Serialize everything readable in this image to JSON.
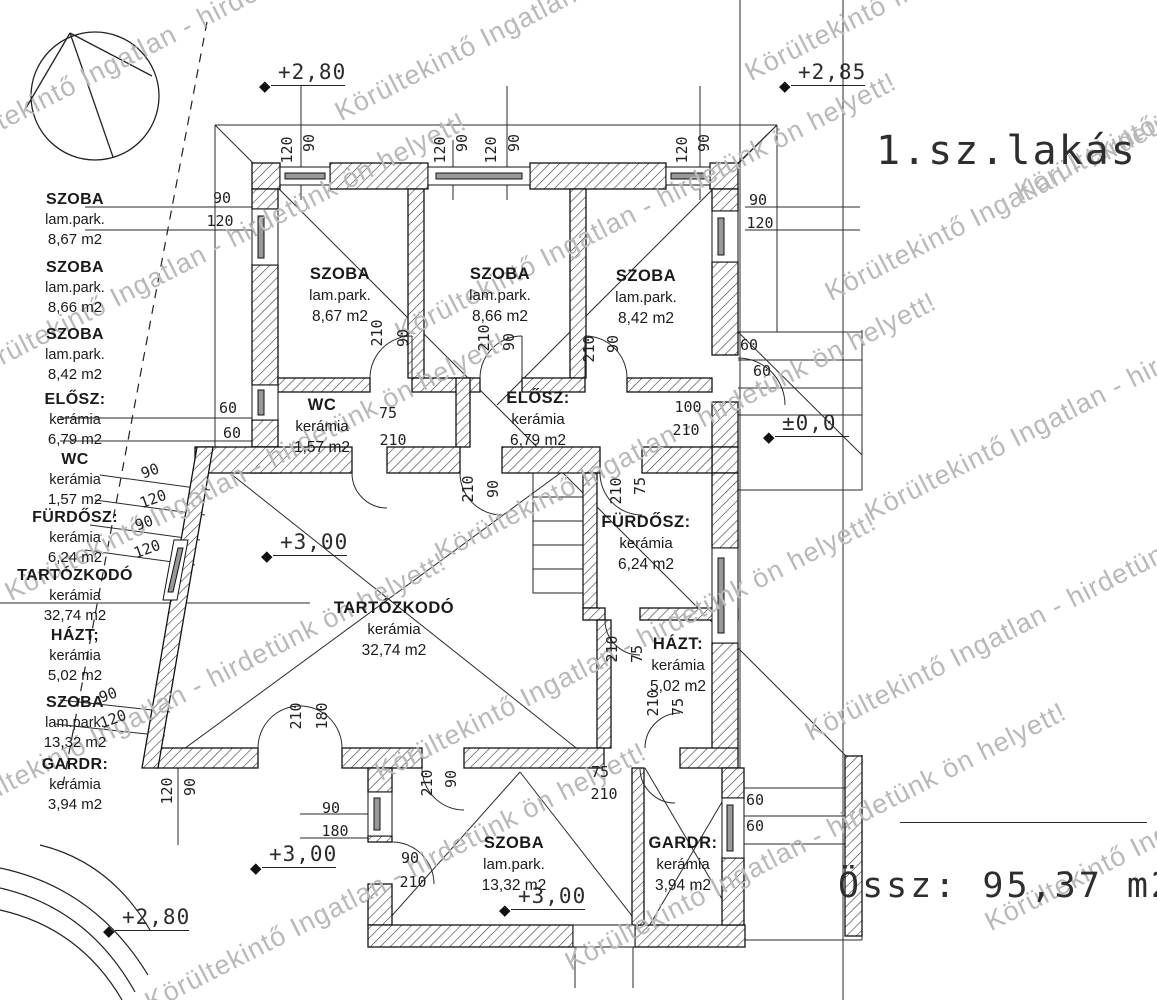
{
  "watermark": {
    "text": "Körültekintő Ingatlan - hirdetünk ön helyett!",
    "color": "#b9b9b9",
    "positions": [
      {
        "x": -70,
        "y": 140
      },
      {
        "x": 330,
        "y": 100
      },
      {
        "x": 740,
        "y": 60
      },
      {
        "x": 1010,
        "y": 180
      },
      {
        "x": -40,
        "y": 360
      },
      {
        "x": 390,
        "y": 320
      },
      {
        "x": 820,
        "y": 280
      },
      {
        "x": 0,
        "y": 580
      },
      {
        "x": 430,
        "y": 540
      },
      {
        "x": 860,
        "y": 500
      },
      {
        "x": -60,
        "y": 800
      },
      {
        "x": 370,
        "y": 760
      },
      {
        "x": 800,
        "y": 720
      },
      {
        "x": 140,
        "y": 990
      },
      {
        "x": 560,
        "y": 950
      },
      {
        "x": 980,
        "y": 910
      }
    ]
  },
  "legend": {
    "title": "1.sz.lakás",
    "total": "Össz: 95,37 m2",
    "entries": [
      {
        "name": "SZOBA",
        "material": "lam.park.",
        "area": "8,67 m2",
        "y": 190
      },
      {
        "name": "SZOBA",
        "material": "lam.park.",
        "area": "8,66 m2",
        "y": 258
      },
      {
        "name": "SZOBA",
        "material": "lam.park.",
        "area": "8,42 m2",
        "y": 325
      },
      {
        "name": "ELŐSZ:",
        "material": "kerámia",
        "area": "6,79 m2",
        "y": 390
      },
      {
        "name": "WC",
        "material": "kerámia",
        "area": "1,57 m2",
        "y": 450
      },
      {
        "name": "FÜRDŐSZ:",
        "material": "kerámia",
        "area": "6,24 m2",
        "y": 508
      },
      {
        "name": "TARTÓZKODÓ",
        "material": "kerámia",
        "area": "32,74 m2",
        "y": 566
      },
      {
        "name": "HÁZT;",
        "material": "kerámia",
        "area": "5,02 m2",
        "y": 626
      },
      {
        "name": "SZOBA",
        "material": "lam.park.",
        "area": "13,32 m2",
        "y": 693
      },
      {
        "name": "GARDR:",
        "material": "kerámia",
        "area": "3,94 m2",
        "y": 755
      }
    ]
  },
  "rooms": [
    {
      "name": "SZOBA",
      "material": "lam.park.",
      "area": "8,67 m2",
      "x": 340,
      "y": 264
    },
    {
      "name": "SZOBA",
      "material": "lam.park.",
      "area": "8,66 m2",
      "x": 500,
      "y": 264
    },
    {
      "name": "SZOBA",
      "material": "lam.park.",
      "area": "8,42 m2",
      "x": 646,
      "y": 266
    },
    {
      "name": "WC",
      "material": "kerámia",
      "area": "1,57 m2",
      "x": 322,
      "y": 395
    },
    {
      "name": "ELŐSZ:",
      "material": "kerámia",
      "area": "6,79 m2",
      "x": 538,
      "y": 388
    },
    {
      "name": "FÜRDŐSZ:",
      "material": "kerámia",
      "area": "6,24 m2",
      "x": 646,
      "y": 512
    },
    {
      "name": "TARTÓZKODÓ",
      "material": "kerámia",
      "area": "32,74 m2",
      "x": 394,
      "y": 598
    },
    {
      "name": "HÁZT:",
      "material": "kerámia",
      "area": "5,02 m2",
      "x": 678,
      "y": 634
    },
    {
      "name": "SZOBA",
      "material": "lam.park.",
      "area": "13,32 m2",
      "x": 514,
      "y": 833
    },
    {
      "name": "GARDR:",
      "material": "kerámia",
      "area": "3,94 m2",
      "x": 683,
      "y": 833
    }
  ],
  "elevation_markers": [
    {
      "label": "+2,80",
      "x": 266,
      "y": 86
    },
    {
      "label": "+2,85",
      "x": 786,
      "y": 86
    },
    {
      "label": "±0,0",
      "x": 770,
      "y": 437
    },
    {
      "label": "+3,00",
      "x": 268,
      "y": 556
    },
    {
      "label": "+3,00",
      "x": 257,
      "y": 868
    },
    {
      "label": "+3,00",
      "x": 506,
      "y": 910
    },
    {
      "label": "+2,80",
      "x": 110,
      "y": 931
    }
  ],
  "dim_labels": [
    {
      "t": "120",
      "x": 287,
      "y": 150,
      "r": -90
    },
    {
      "t": "90",
      "x": 309,
      "y": 143,
      "r": -90
    },
    {
      "t": "120",
      "x": 440,
      "y": 150,
      "r": -90
    },
    {
      "t": "90",
      "x": 462,
      "y": 143,
      "r": -90
    },
    {
      "t": "120",
      "x": 491,
      "y": 150,
      "r": -90
    },
    {
      "t": "90",
      "x": 514,
      "y": 143,
      "r": -90
    },
    {
      "t": "120",
      "x": 682,
      "y": 150,
      "r": -90
    },
    {
      "t": "90",
      "x": 704,
      "y": 143,
      "r": -90
    },
    {
      "t": "90",
      "x": 222,
      "y": 198,
      "r": 0
    },
    {
      "t": "120",
      "x": 220,
      "y": 221,
      "r": 0
    },
    {
      "t": "90",
      "x": 758,
      "y": 200,
      "r": 0
    },
    {
      "t": "120",
      "x": 760,
      "y": 223,
      "r": 0
    },
    {
      "t": "60",
      "x": 749,
      "y": 345,
      "r": 0
    },
    {
      "t": "60",
      "x": 762,
      "y": 371,
      "r": 0
    },
    {
      "t": "60",
      "x": 228,
      "y": 408,
      "r": 0
    },
    {
      "t": "60",
      "x": 232,
      "y": 433,
      "r": 0
    },
    {
      "t": "90",
      "x": 150,
      "y": 471,
      "r": -20
    },
    {
      "t": "120",
      "x": 153,
      "y": 499,
      "r": -20
    },
    {
      "t": "90",
      "x": 144,
      "y": 523,
      "r": -20
    },
    {
      "t": "120",
      "x": 147,
      "y": 549,
      "r": -20
    },
    {
      "t": "90",
      "x": 108,
      "y": 695,
      "r": -20
    },
    {
      "t": "120",
      "x": 113,
      "y": 719,
      "r": -20
    },
    {
      "t": "210",
      "x": 296,
      "y": 716,
      "r": -90
    },
    {
      "t": "180",
      "x": 322,
      "y": 716,
      "r": -90
    },
    {
      "t": "120",
      "x": 167,
      "y": 791,
      "r": -90
    },
    {
      "t": "90",
      "x": 190,
      "y": 787,
      "r": -90
    },
    {
      "t": "90",
      "x": 331,
      "y": 808,
      "r": 0
    },
    {
      "t": "180",
      "x": 335,
      "y": 831,
      "r": 0
    },
    {
      "t": "210",
      "x": 377,
      "y": 333,
      "r": -90
    },
    {
      "t": "90",
      "x": 403,
      "y": 338,
      "r": -90
    },
    {
      "t": "210",
      "x": 484,
      "y": 338,
      "r": -90
    },
    {
      "t": "90",
      "x": 509,
      "y": 342,
      "r": -90
    },
    {
      "t": "210",
      "x": 589,
      "y": 349,
      "r": -90
    },
    {
      "t": "90",
      "x": 613,
      "y": 344,
      "r": -90
    },
    {
      "t": "75",
      "x": 388,
      "y": 413,
      "r": 0
    },
    {
      "t": "210",
      "x": 393,
      "y": 440,
      "r": 0
    },
    {
      "t": "210",
      "x": 468,
      "y": 489,
      "r": -90
    },
    {
      "t": "90",
      "x": 493,
      "y": 489,
      "r": -90
    },
    {
      "t": "210",
      "x": 616,
      "y": 491,
      "r": -90
    },
    {
      "t": "75",
      "x": 640,
      "y": 486,
      "r": -90
    },
    {
      "t": "100",
      "x": 688,
      "y": 407,
      "r": 0
    },
    {
      "t": "210",
      "x": 686,
      "y": 430,
      "r": 0
    },
    {
      "t": "210",
      "x": 612,
      "y": 649,
      "r": -90
    },
    {
      "t": "75",
      "x": 637,
      "y": 654,
      "r": -90
    },
    {
      "t": "210",
      "x": 653,
      "y": 703,
      "r": -90
    },
    {
      "t": "75",
      "x": 678,
      "y": 707,
      "r": -90
    },
    {
      "t": "210",
      "x": 427,
      "y": 783,
      "r": -90
    },
    {
      "t": "90",
      "x": 451,
      "y": 779,
      "r": -90
    },
    {
      "t": "75",
      "x": 600,
      "y": 772,
      "r": 0
    },
    {
      "t": "210",
      "x": 604,
      "y": 794,
      "r": 0
    },
    {
      "t": "90",
      "x": 410,
      "y": 858,
      "r": 0
    },
    {
      "t": "210",
      "x": 413,
      "y": 882,
      "r": 0
    },
    {
      "t": "60",
      "x": 755,
      "y": 800,
      "r": 0
    },
    {
      "t": "60",
      "x": 755,
      "y": 826,
      "r": 0
    }
  ]
}
